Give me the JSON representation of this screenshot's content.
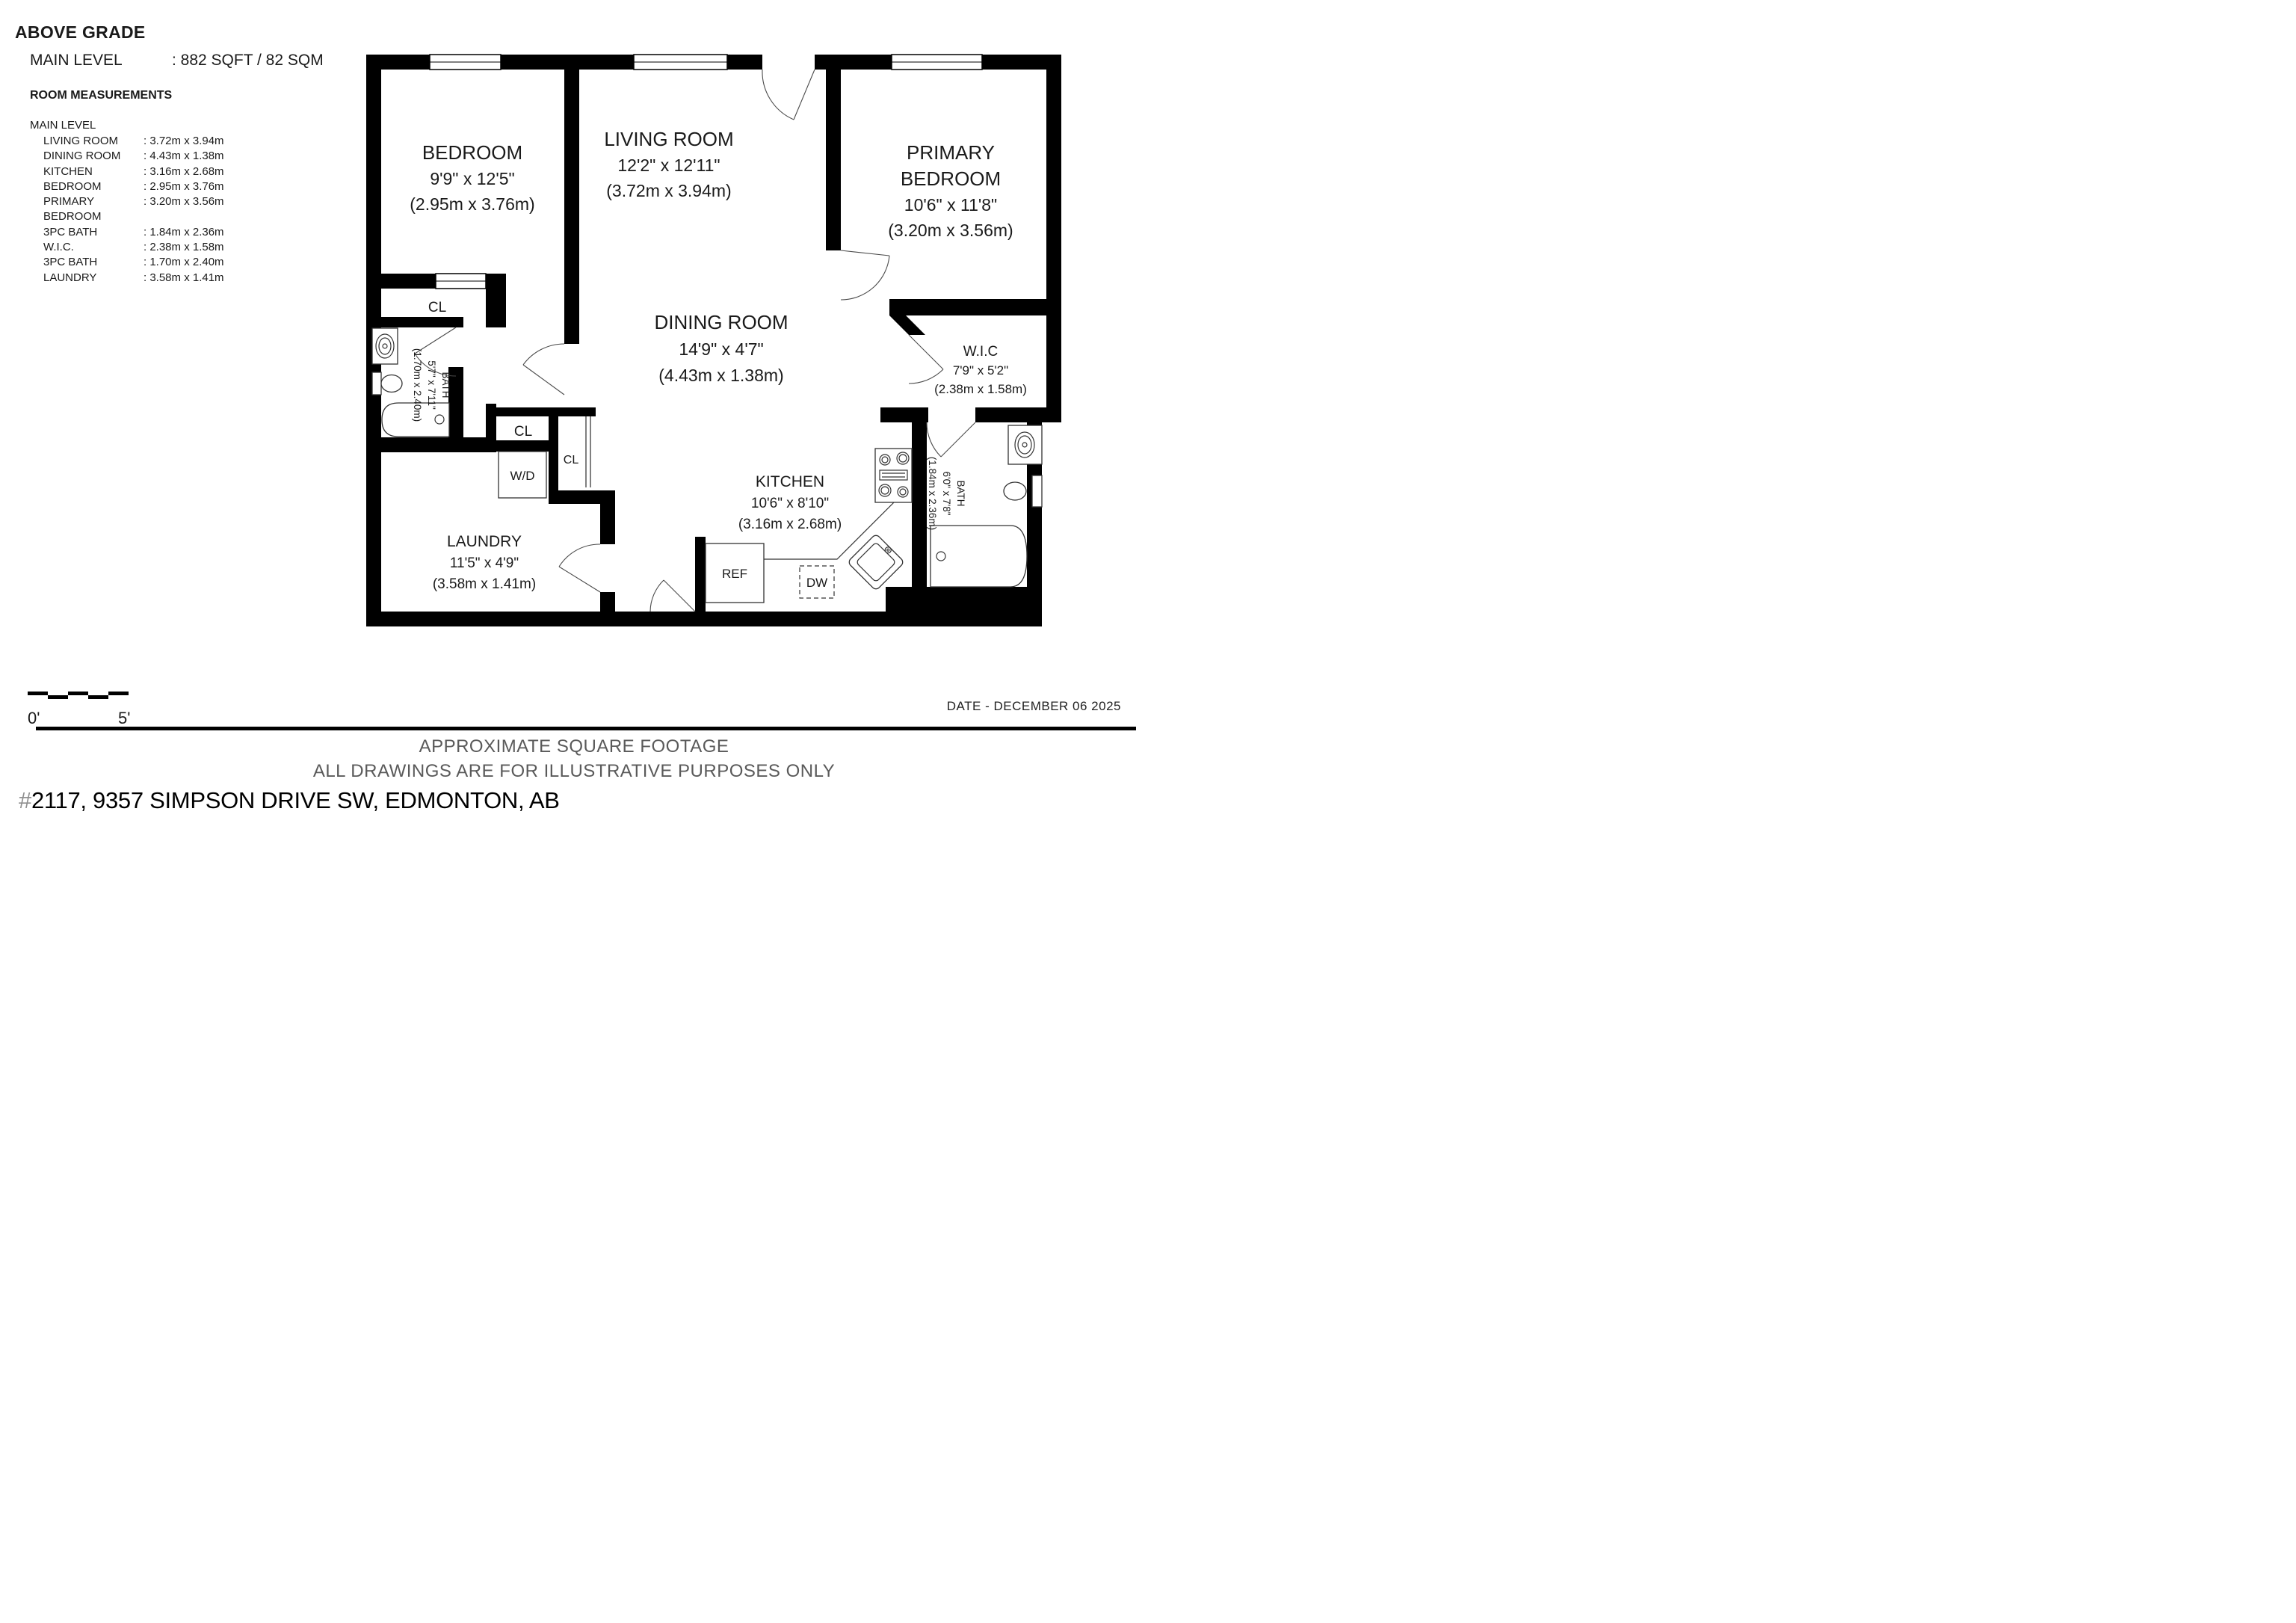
{
  "header": {
    "above_grade": "ABOVE GRADE",
    "main_level_label": "MAIN LEVEL",
    "main_level_value": ": 882 SQFT / 82 SQM"
  },
  "measurements": {
    "title": "ROOM MEASUREMENTS",
    "level_label": "MAIN LEVEL",
    "rows": [
      {
        "label": "LIVING ROOM",
        "value": ": 3.72m x 3.94m"
      },
      {
        "label": "DINING ROOM",
        "value": ": 4.43m x 1.38m"
      },
      {
        "label": "KITCHEN",
        "value": ": 3.16m x 2.68m"
      },
      {
        "label": "BEDROOM",
        "value": ": 2.95m x 3.76m"
      },
      {
        "label": "PRIMARY BEDROOM",
        "value": ": 3.20m x 3.56m"
      },
      {
        "label": "3PC BATH",
        "value": ": 1.84m x 2.36m"
      },
      {
        "label": "W.I.C.",
        "value": ": 2.38m x 1.58m"
      },
      {
        "label": "3PC BATH",
        "value": ": 1.70m x 2.40m"
      },
      {
        "label": "LAUNDRY",
        "value": ": 3.58m x 1.41m"
      }
    ]
  },
  "floorplan": {
    "rooms": {
      "bedroom": {
        "name": "BEDROOM",
        "dims_ft": "9'9\" x 12'5\"",
        "dims_m": "(2.95m x 3.76m)"
      },
      "living_room": {
        "name": "LIVING ROOM",
        "dims_ft": "12'2\" x 12'11\"",
        "dims_m": "(3.72m x 3.94m)"
      },
      "primary_bedroom": {
        "name_line1": "PRIMARY",
        "name_line2": "BEDROOM",
        "dims_ft": "10'6\" x 11'8\"",
        "dims_m": "(3.20m x 3.56m)"
      },
      "dining_room": {
        "name": "DINING ROOM",
        "dims_ft": "14'9\" x 4'7\"",
        "dims_m": "(4.43m x 1.38m)"
      },
      "wic": {
        "name": "W.I.C",
        "dims_ft": "7'9\" x 5'2\"",
        "dims_m": "(2.38m x 1.58m)"
      },
      "kitchen": {
        "name": "KITCHEN",
        "dims_ft": "10'6\" x 8'10\"",
        "dims_m": "(3.16m x 2.68m)"
      },
      "laundry": {
        "name": "LAUNDRY",
        "dims_ft": "11'5\" x 4'9\"",
        "dims_m": "(3.58m x 1.41m)"
      },
      "bath_left": {
        "name": "BATH",
        "dims_ft": "5'7\" x 7'11\"",
        "dims_m": "(1.70m x 2.40m)"
      },
      "bath_right": {
        "name": "BATH",
        "dims_ft": "6'0\" x 7'8\"",
        "dims_m": "(1.84m x 2.36m)"
      }
    },
    "closets": [
      "CL",
      "CL",
      "CL"
    ],
    "appliances": {
      "washer_dryer": "W/D",
      "fridge": "REF",
      "dishwasher": "DW"
    }
  },
  "scale": {
    "start": "0'",
    "end": "5'"
  },
  "footer": {
    "date": "DATE - DECEMBER 06 2025",
    "line1": "APPROXIMATE SQUARE FOOTAGE",
    "line2": "ALL DRAWINGS ARE FOR ILLUSTRATIVE PURPOSES ONLY",
    "address_hash": "#",
    "address": "2117, 9357 SIMPSON DRIVE SW, EDMONTON, AB"
  },
  "colors": {
    "wall": "#000000",
    "text": "#1a1a1a",
    "muted": "#5a5a5a"
  }
}
